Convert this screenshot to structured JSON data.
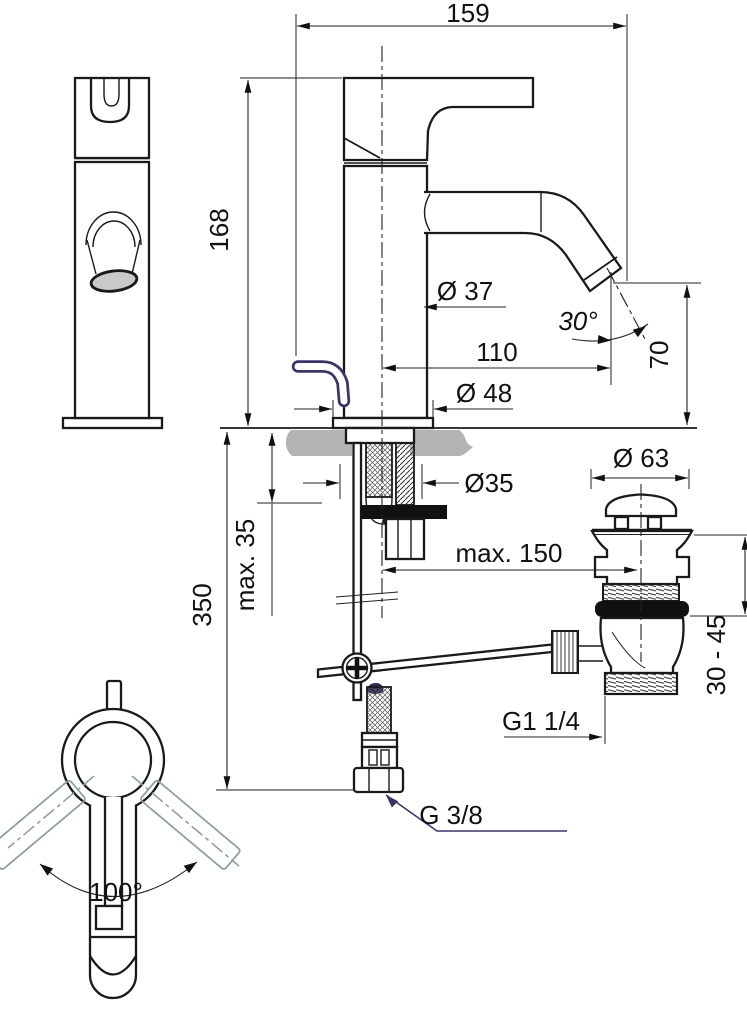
{
  "drawing_title": "Single-lever basin mixer installation drawing",
  "labels": {
    "width_total": "159",
    "height_body": "168",
    "dia_body": "Ø 37",
    "spout_angle": "30°",
    "spout_reach": "110",
    "spout_height": "70",
    "dia_base": "Ø 48",
    "dia_hole": "Ø35",
    "max_deck_thickness": "max. 35",
    "hose_length": "350",
    "max_rod_reach": "max. 150",
    "dia_waste_cap": "Ø 63",
    "waste_clamp_range": "30 - 45",
    "waste_thread": "G1 1/4",
    "supply_thread": "G 3/8",
    "swivel_angle": "100°"
  },
  "colors": {
    "line": "#1a1a1a",
    "dimension": "#222222",
    "counter_gray": "#b4b4b4",
    "aerator_gray": "#c9c9c9",
    "swivel_gray": "#8ea19e",
    "accent_purple": "#3f3366"
  }
}
